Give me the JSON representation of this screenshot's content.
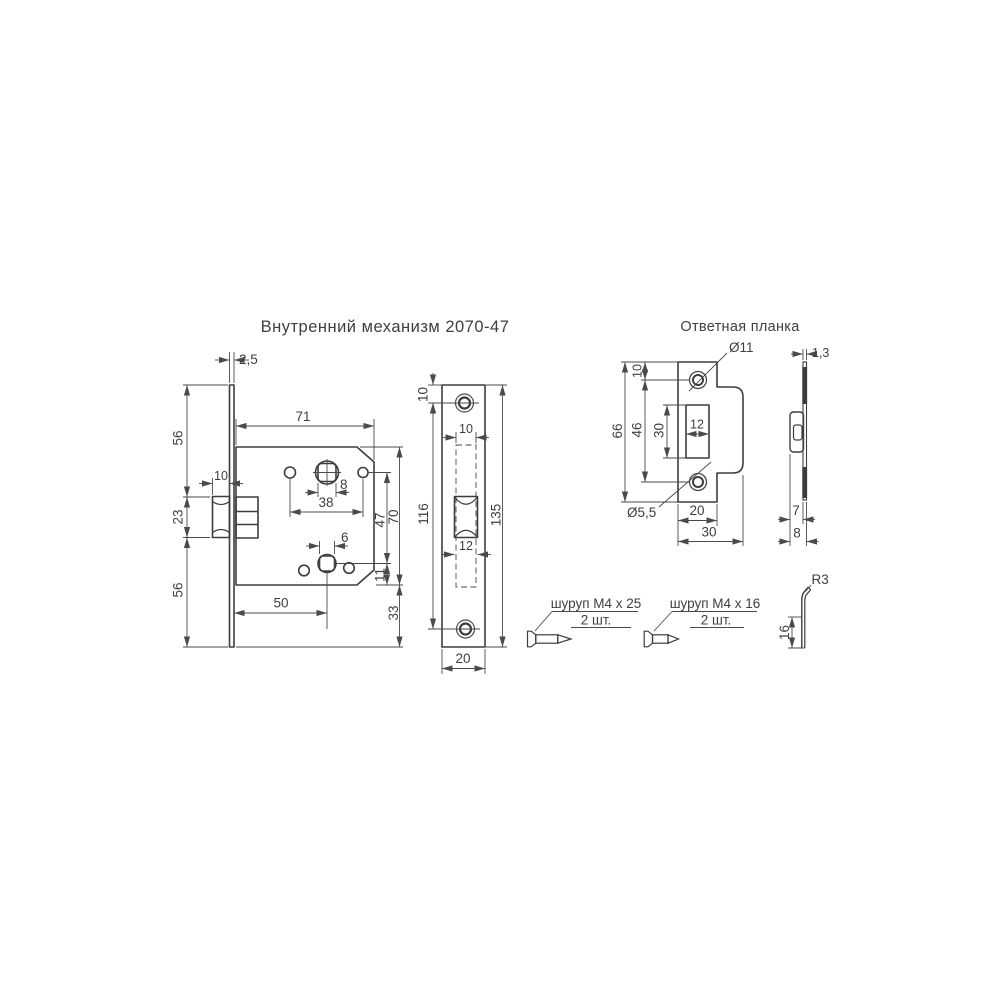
{
  "titles": {
    "mechanism": "Внутренний механизм 2070-47",
    "strike": "Ответная планка"
  },
  "mech": {
    "d2_5": "2,5",
    "d56a": "56",
    "d23": "23",
    "d56b": "56",
    "d10latch": "10",
    "d71": "71",
    "d8": "8",
    "d38": "38",
    "d47": "47",
    "d70": "70",
    "d6": "6",
    "d11": "11",
    "d50": "50",
    "d33": "33"
  },
  "face": {
    "d10top": "10",
    "d10slot": "10",
    "d116": "116",
    "d135": "135",
    "d12": "12",
    "d20": "20"
  },
  "strike": {
    "dia11": "Ø11",
    "d10": "10",
    "d66": "66",
    "d46": "46",
    "d30slot": "30",
    "d12": "12",
    "dia55": "Ø5,5",
    "d20": "20",
    "d30": "30",
    "d13": "1,3",
    "d7": "7",
    "d8": "8",
    "r3": "R3",
    "d16": "16"
  },
  "screws": {
    "s1": "шуруп М4 х 25",
    "s1qty": "2 шт.",
    "s2": "шуруп М4 х 16",
    "s2qty": "2 шт."
  },
  "colors": {
    "line": "#3d3d3d",
    "background": "#ffffff"
  }
}
